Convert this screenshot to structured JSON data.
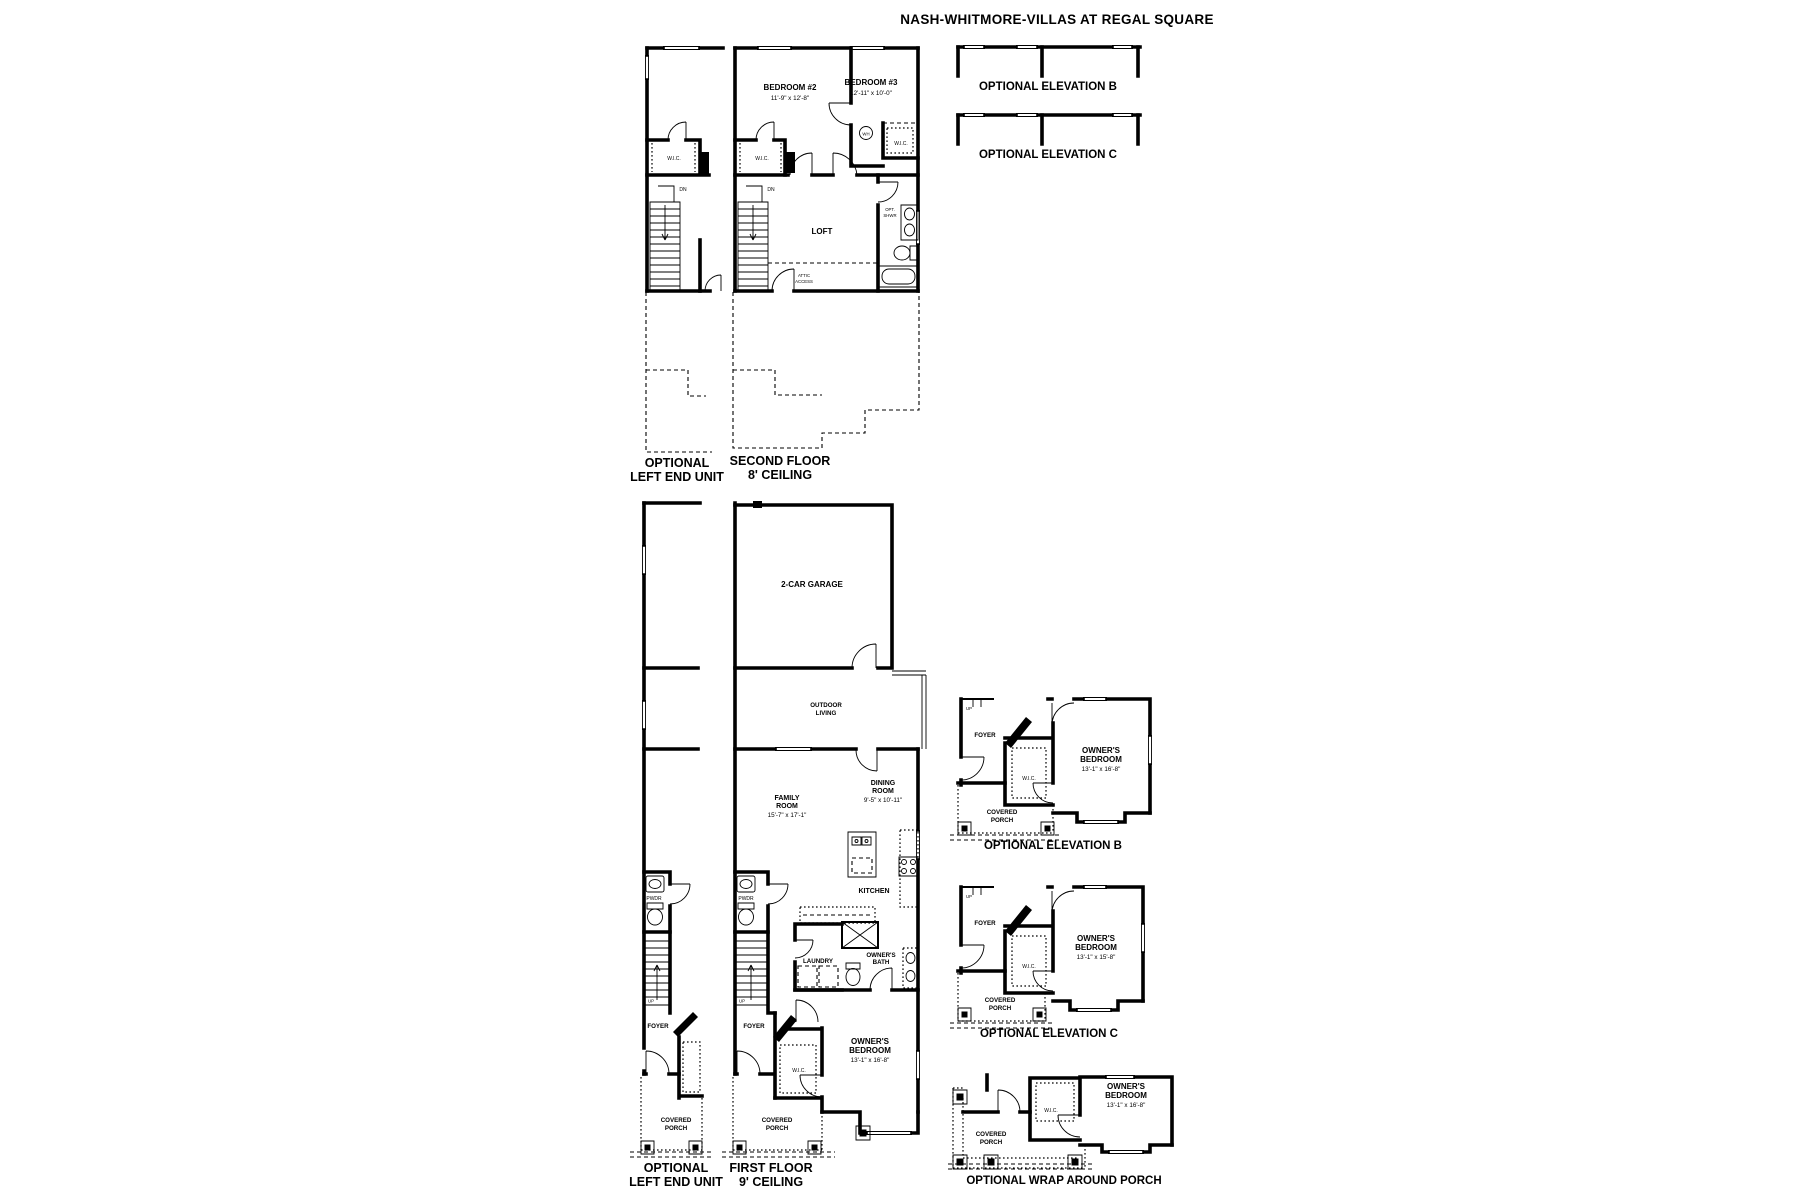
{
  "title": "NASH-WHITMORE-VILLAS AT REGAL SQUARE",
  "common": {
    "wic": "W.I.C.",
    "pwdr": "PWDR",
    "foyer": "FOYER",
    "up": "UP",
    "dn": "DN",
    "wh": "WH",
    "opt": "OPT.",
    "shwr": "SHWR",
    "attic": "ATTIC",
    "access": "ACCESS",
    "covered": "COVERED",
    "porch": "PORCH",
    "outdoor": "OUTDOOR",
    "living": "LIVING",
    "owners": "OWNER'S",
    "bedroom": "BEDROOM",
    "bath": "BATH"
  },
  "second_floor": {
    "bedroom2": {
      "name": "BEDROOM #2",
      "dims": "11'-9\" x 12'-8\""
    },
    "bedroom3": {
      "name": "BEDROOM #3",
      "dims": "12'-11\" x 10'-0\""
    },
    "loft": "LOFT",
    "caption": [
      "SECOND FLOOR",
      "8' CEILING"
    ],
    "left_unit_caption": [
      "OPTIONAL",
      "LEFT END UNIT"
    ]
  },
  "first_floor": {
    "garage": "2-CAR GARAGE",
    "kitchen": "KITCHEN",
    "laundry": "LAUNDRY",
    "family_room": {
      "line1": "FAMILY",
      "line2": "ROOM",
      "dims": "15'-7\" x 17'-1\""
    },
    "dining_room": {
      "line1": "DINING",
      "line2": "ROOM",
      "dims": "9'-5\" x 10'-11\""
    },
    "owners_bedroom": {
      "dims": "13'-1\" x 16'-8\""
    },
    "caption": [
      "FIRST FLOOR",
      "9' CEILING"
    ],
    "left_unit_caption": [
      "OPTIONAL",
      "LEFT END UNIT"
    ]
  },
  "elevation_options": {
    "top_b": "OPTIONAL ELEVATION B",
    "top_c": "OPTIONAL ELEVATION C",
    "plan_b": {
      "caption": "OPTIONAL ELEVATION B",
      "bedroom_dims": "13'-1\" x 16'-8\""
    },
    "plan_c": {
      "caption": "OPTIONAL ELEVATION C",
      "bedroom_dims": "13'-1\" x 15'-8\""
    },
    "wrap": {
      "caption": "OPTIONAL WRAP AROUND PORCH",
      "bedroom_dims": "13'-1\" x 16'-8\""
    }
  }
}
